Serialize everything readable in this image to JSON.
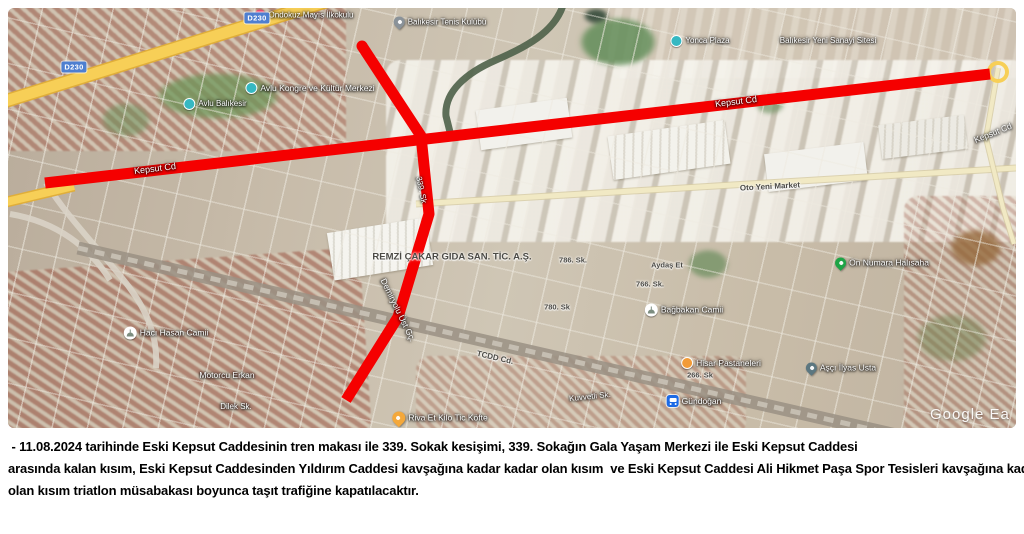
{
  "map": {
    "google_watermark": "Google Ea",
    "road_shields": [
      {
        "label": "D230",
        "x": 66,
        "y": 59
      },
      {
        "label": "D230",
        "x": 249,
        "y": 10
      }
    ],
    "labels": [
      {
        "text": "Kepsut Cd",
        "x": 147,
        "y": 161,
        "rot": -7,
        "tone": "onred",
        "size": 9
      },
      {
        "text": "Kepsut Cd",
        "x": 728,
        "y": 94,
        "rot": -7,
        "tone": "light",
        "size": 9
      },
      {
        "text": "Kepsut Cd",
        "x": 985,
        "y": 125,
        "rot": -22,
        "tone": "light",
        "size": 8.5
      },
      {
        "text": "339. Sk",
        "x": 413,
        "y": 182,
        "rot": 78,
        "tone": "light",
        "size": 8
      },
      {
        "text": "Demiryolu Üst Gç.",
        "x": 390,
        "y": 302,
        "rot": 64,
        "tone": "light",
        "size": 8.5
      },
      {
        "text": "REMZİ ÇAKAR GIDA SAN. TİC. A.Ş.",
        "x": 444,
        "y": 249,
        "rot": 0,
        "tone": "dark",
        "size": 9.5
      },
      {
        "text": "786. Sk.",
        "x": 565,
        "y": 252,
        "rot": 0,
        "tone": "dark",
        "size": 7.5
      },
      {
        "text": "766. Sk.",
        "x": 642,
        "y": 276,
        "rot": 0,
        "tone": "dark",
        "size": 7.5
      },
      {
        "text": "780. Sk",
        "x": 549,
        "y": 299,
        "rot": 0,
        "tone": "dark",
        "size": 7.5
      },
      {
        "text": "Aydaş Et",
        "x": 659,
        "y": 257,
        "rot": 0,
        "tone": "dark",
        "size": 7.5
      },
      {
        "text": "Bağbakan Camii",
        "x": 676,
        "y": 302,
        "rot": 0,
        "tone": "light",
        "size": 8.5,
        "icon": "mosque"
      },
      {
        "text": "On Numara Halısaha",
        "x": 874,
        "y": 255,
        "rot": 0,
        "tone": "light",
        "size": 8.5,
        "icon": "green-pin"
      },
      {
        "text": "Hisar Pastaneleri",
        "x": 713,
        "y": 355,
        "rot": 0,
        "tone": "light",
        "size": 8.5,
        "icon": "orange-circle"
      },
      {
        "text": "266. Sk",
        "x": 692,
        "y": 367,
        "rot": 0,
        "tone": "dark",
        "size": 7.5
      },
      {
        "text": "Aşçı İlyas Usta",
        "x": 833,
        "y": 360,
        "rot": 0,
        "tone": "light",
        "size": 8.5,
        "icon": "dark-pin"
      },
      {
        "text": "Gündoğan",
        "x": 686,
        "y": 393,
        "rot": 0,
        "tone": "light",
        "size": 8.5,
        "icon": "bus"
      },
      {
        "text": "Hacı Hasan Camii",
        "x": 158,
        "y": 325,
        "rot": 0,
        "tone": "light",
        "size": 8.5,
        "icon": "mosque"
      },
      {
        "text": "Motorcu Erkan",
        "x": 219,
        "y": 367,
        "rot": 0,
        "tone": "light",
        "size": 8.5
      },
      {
        "text": "Dilek Sk.",
        "x": 228,
        "y": 399,
        "rot": 0,
        "tone": "light",
        "size": 8
      },
      {
        "text": "TCDD Cd.",
        "x": 487,
        "y": 350,
        "rot": 13,
        "tone": "dark",
        "size": 8
      },
      {
        "text": "Kuvvetli Sk.",
        "x": 582,
        "y": 389,
        "rot": -6,
        "tone": "light",
        "size": 8
      },
      {
        "text": "Riva Et Kilo Tic Köfte",
        "x": 432,
        "y": 410,
        "rot": 0,
        "tone": "light",
        "size": 8.5,
        "icon": "yellow-pin"
      },
      {
        "text": "Avlu Kongre ve Kültür Merkezi",
        "x": 302,
        "y": 80,
        "rot": 0,
        "tone": "light",
        "size": 8.5,
        "icon": "teal-circle"
      },
      {
        "text": "Avlu Balıkesir",
        "x": 207,
        "y": 96,
        "rot": 0,
        "tone": "light",
        "size": 8,
        "icon": "teal-circle"
      },
      {
        "text": "Yonca Plaza",
        "x": 692,
        "y": 33,
        "rot": 0,
        "tone": "light",
        "size": 8,
        "icon": "teal-circle"
      },
      {
        "text": "Ondokuz Mayıs İlkokulu",
        "x": 296,
        "y": 7,
        "rot": 0,
        "tone": "light",
        "size": 8,
        "icon": "red-pin"
      },
      {
        "text": "Balıkesir Tenis Kulübü",
        "x": 432,
        "y": 14,
        "rot": 0,
        "tone": "light",
        "size": 8,
        "icon": "gray-pin"
      },
      {
        "text": "Balıkesir Yeni Sanayi Sitesi",
        "x": 820,
        "y": 33,
        "rot": 0,
        "tone": "light",
        "size": 8
      },
      {
        "text": "Oto Yeni Market",
        "x": 762,
        "y": 179,
        "rot": -3,
        "tone": "dark",
        "size": 8
      }
    ],
    "geometry": {
      "red_color": "#f50000",
      "red_width": 11,
      "red_routes": [
        {
          "name": "kepsut-caddesi-closure",
          "points": [
            [
              37,
              175
            ],
            [
              982,
              66
            ]
          ],
          "round_start": false
        },
        {
          "name": "339-sokak-demiryolu-closure",
          "points": [
            [
              354,
              38
            ],
            [
              413,
              128
            ],
            [
              421,
              206
            ],
            [
              390,
              309
            ],
            [
              338,
              392
            ]
          ],
          "round_start": true
        }
      ],
      "yellow_roads": [
        {
          "points": [
            [
              -12,
              96
            ],
            [
              342,
              -14
            ]
          ],
          "w": 11
        },
        {
          "points": [
            [
              -10,
              196
            ],
            [
              66,
              178
            ]
          ],
          "w": 8
        }
      ],
      "minor_roads": [
        {
          "points": [
            [
              408,
              196
            ],
            [
              1008,
              160
            ]
          ],
          "w": 5
        },
        {
          "points": [
            [
              990,
              60
            ],
            [
              978,
              130
            ],
            [
              995,
              200
            ],
            [
              1006,
              236
            ]
          ],
          "w": 4
        }
      ],
      "railway": {
        "points": [
          [
            70,
            240
          ],
          [
            910,
            432
          ]
        ]
      },
      "river_path": "M 556 -6 C 548 25 515 40 488 52 C 458 65 436 84 438 108 L 442 124",
      "interchange_paths": [
        "M 38 175 C 60 210 90 240 118 275 C 140 303 150 330 148 360",
        "M 2 206 C 50 214 82 240 102 272"
      ],
      "roundabout": {
        "cx": 990,
        "cy": 64,
        "r": 9
      }
    }
  },
  "caption": {
    "lines": [
      " - 11.08.2024 tarihinde Eski Kepsut Caddesinin tren makası ile 339. Sokak kesişimi, 339. Sokağın Gala Yaşam Merkezi ile Eski Kepsut Caddesi",
      "arasında kalan kısım, Eski Kepsut Caddesinden Yıldırım Caddesi kavşağına kadar kadar olan kısım  ve Eski Kepsut Caddesi Ali Hikmet Paşa Spor Tesisleri kavşağına kadar",
      "olan kısım triatlon müsabakası boyunca taşıt trafiğine kapatılacaktır."
    ]
  }
}
